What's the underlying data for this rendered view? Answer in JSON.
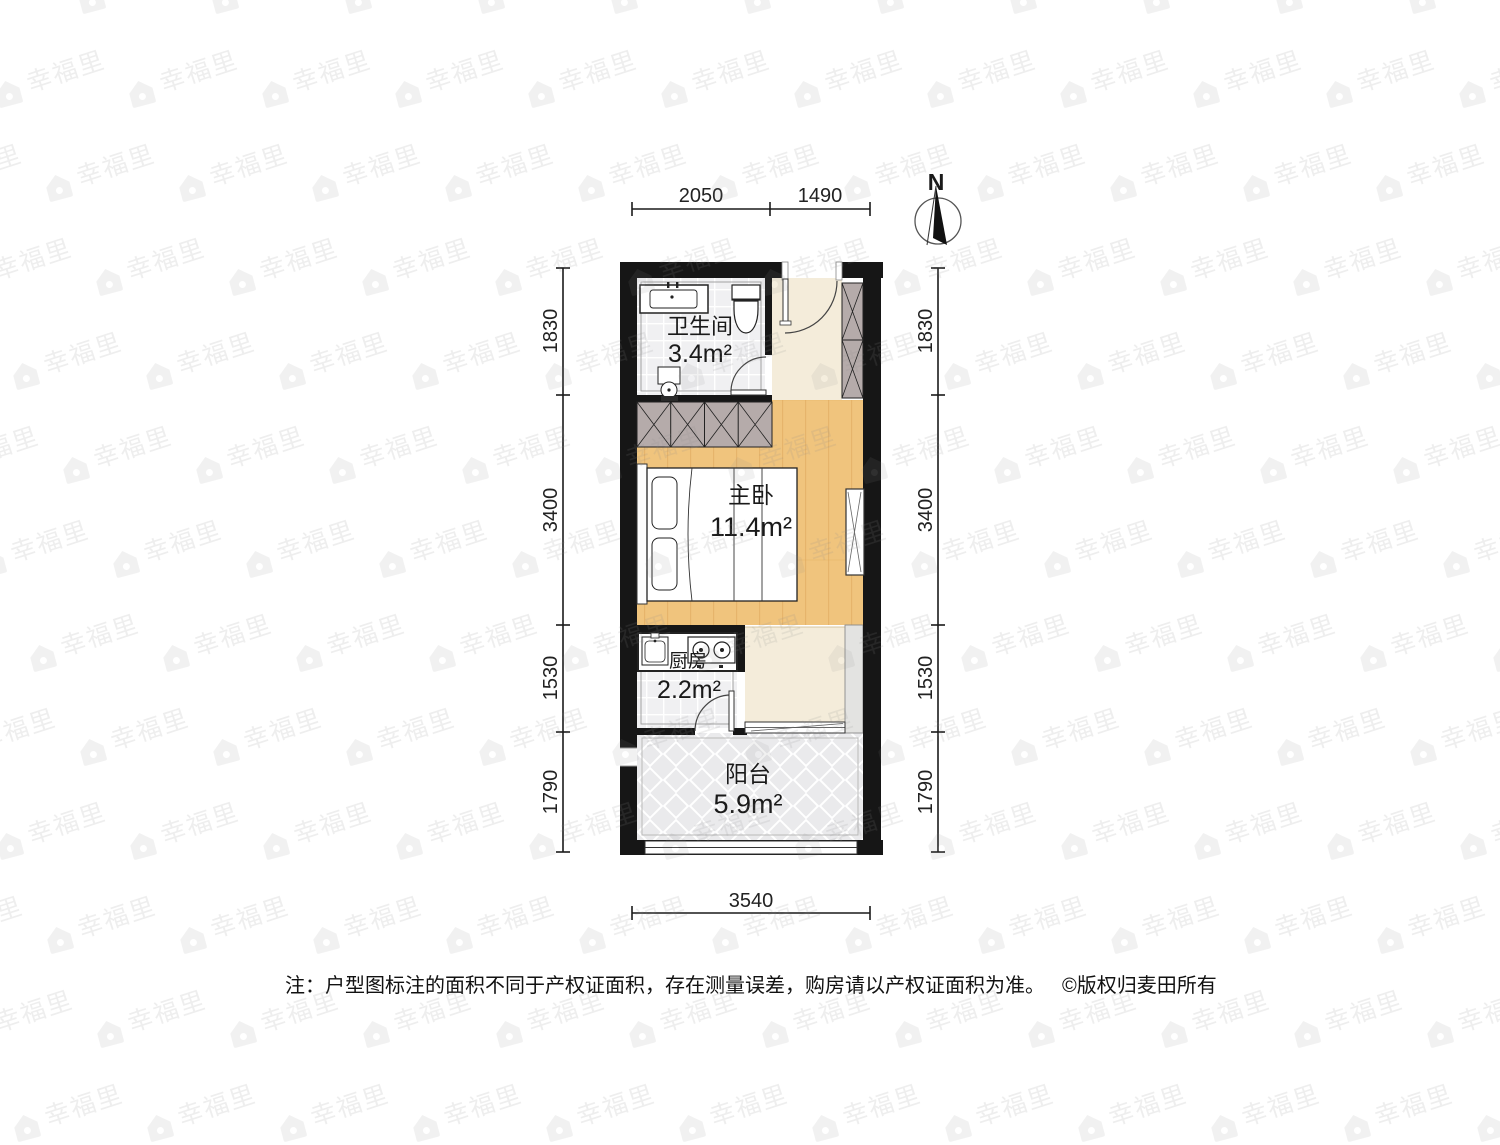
{
  "title": "户型图",
  "north": {
    "label": "N"
  },
  "rooms": [
    {
      "id": "bathroom",
      "name": "卫生间",
      "area": "3.4m²"
    },
    {
      "id": "bedroom",
      "name": "主卧",
      "area": "11.4m²"
    },
    {
      "id": "kitchen",
      "name": "厨房",
      "area": "2.2m²"
    },
    {
      "id": "balcony",
      "name": "阳台",
      "area": "5.9m²"
    }
  ],
  "dimensions": {
    "top": [
      "2050",
      "1490"
    ],
    "bottom": [
      "3540"
    ],
    "left": [
      "1830",
      "3400",
      "1530",
      "1790"
    ],
    "right": [
      "1830",
      "3400",
      "1530",
      "1790"
    ]
  },
  "footnote": {
    "note": "注：户型图标注的面积不同于产权证面积，存在测量误差，购房请以产权证面积为准。",
    "copyright": "©版权归麦田所有"
  },
  "watermark": {
    "text": "幸福里"
  },
  "colors": {
    "wall": "#161616",
    "wood": "#f0c47d",
    "wood-line": "#dfa75c",
    "hallway": "#f4ecda",
    "tile": "#f0f0f2",
    "balcony-tile": "#eaeaec",
    "wardrobe": "#b5abaa",
    "panel": "#e3e3e1",
    "watermark": "#8c8c8c"
  }
}
